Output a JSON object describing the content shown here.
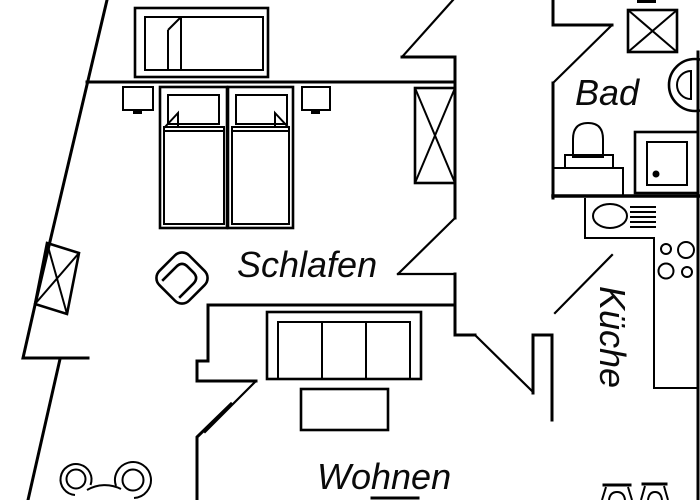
{
  "floorplan": {
    "type": "apartment-floor-plan",
    "background_color": "#ffffff",
    "line_color": "#000000",
    "rooms": {
      "schlafen": {
        "label": "Schlafen"
      },
      "wohnen": {
        "label": "Wohnen"
      },
      "bad": {
        "label": "Bad"
      },
      "kueche": {
        "label": "Küche"
      }
    }
  }
}
